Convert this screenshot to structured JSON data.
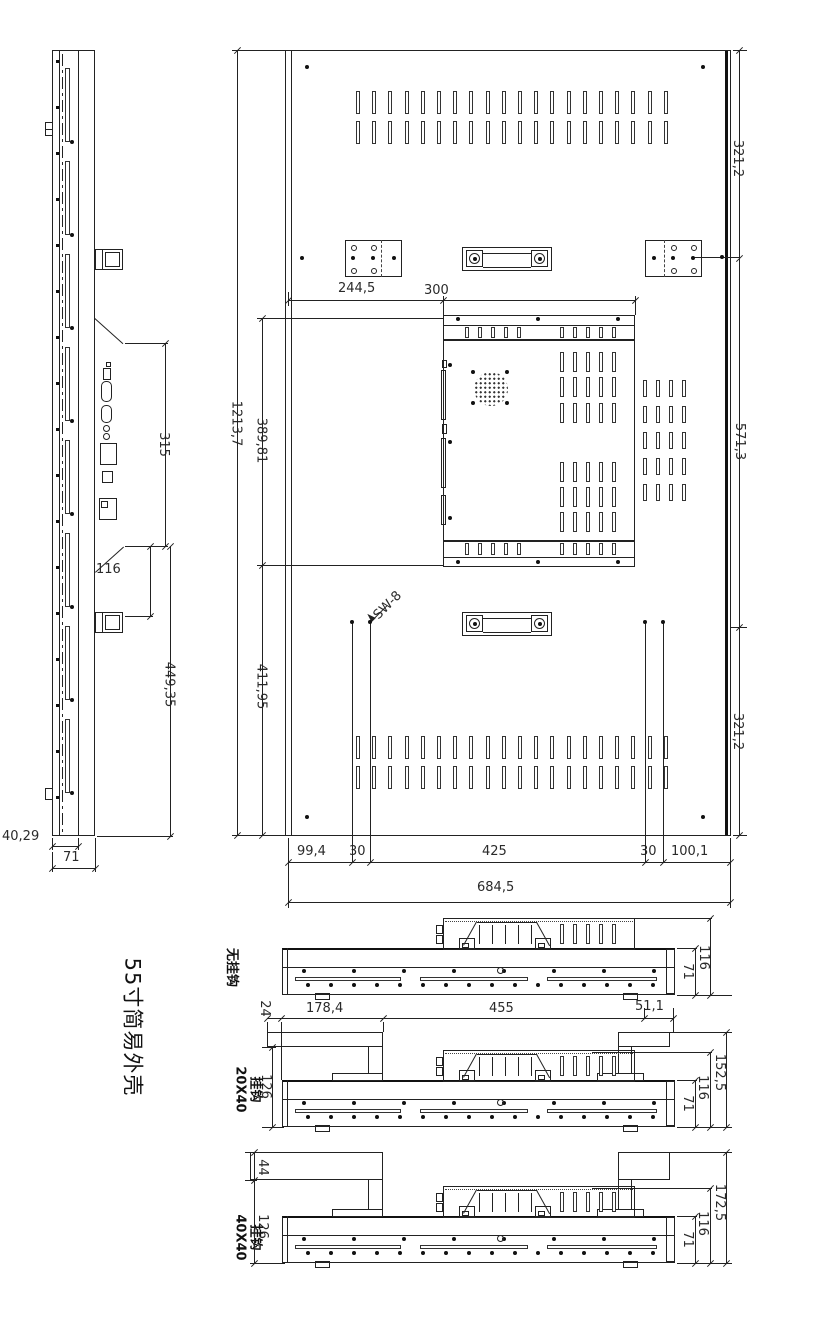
{
  "title": "55寸简易外壳",
  "callout": "SW-8",
  "side": {
    "d315": "315",
    "d116": "116",
    "d449": "449,35",
    "d4029": "40,29",
    "d71": "71"
  },
  "rear": {
    "t321": "321,2",
    "m571": "571,3",
    "b321": "321,2",
    "h1213": "1213,7",
    "u389": "389,81",
    "l411": "411,95",
    "w244": "244,5",
    "w300": "300",
    "b99": "99,4",
    "b30a": "30",
    "b425": "425",
    "b30b": "30",
    "b100": "100,1",
    "b684": "684,5"
  },
  "row": {
    "d24": "24",
    "d178": "178,4",
    "d455": "455",
    "d51": "51,1"
  },
  "v1": {
    "label": "无挂钩",
    "d116": "116",
    "d71": "71"
  },
  "v2": {
    "l1": "20X40",
    "l2": "挂钩",
    "d126": "126",
    "d152": "152,5",
    "d116": "116",
    "d71": "71"
  },
  "v3": {
    "l1": "40X40",
    "l2": "挂钩",
    "d44": "44",
    "d126": "126",
    "d172": "172,5",
    "d116": "116",
    "d71": "71"
  }
}
